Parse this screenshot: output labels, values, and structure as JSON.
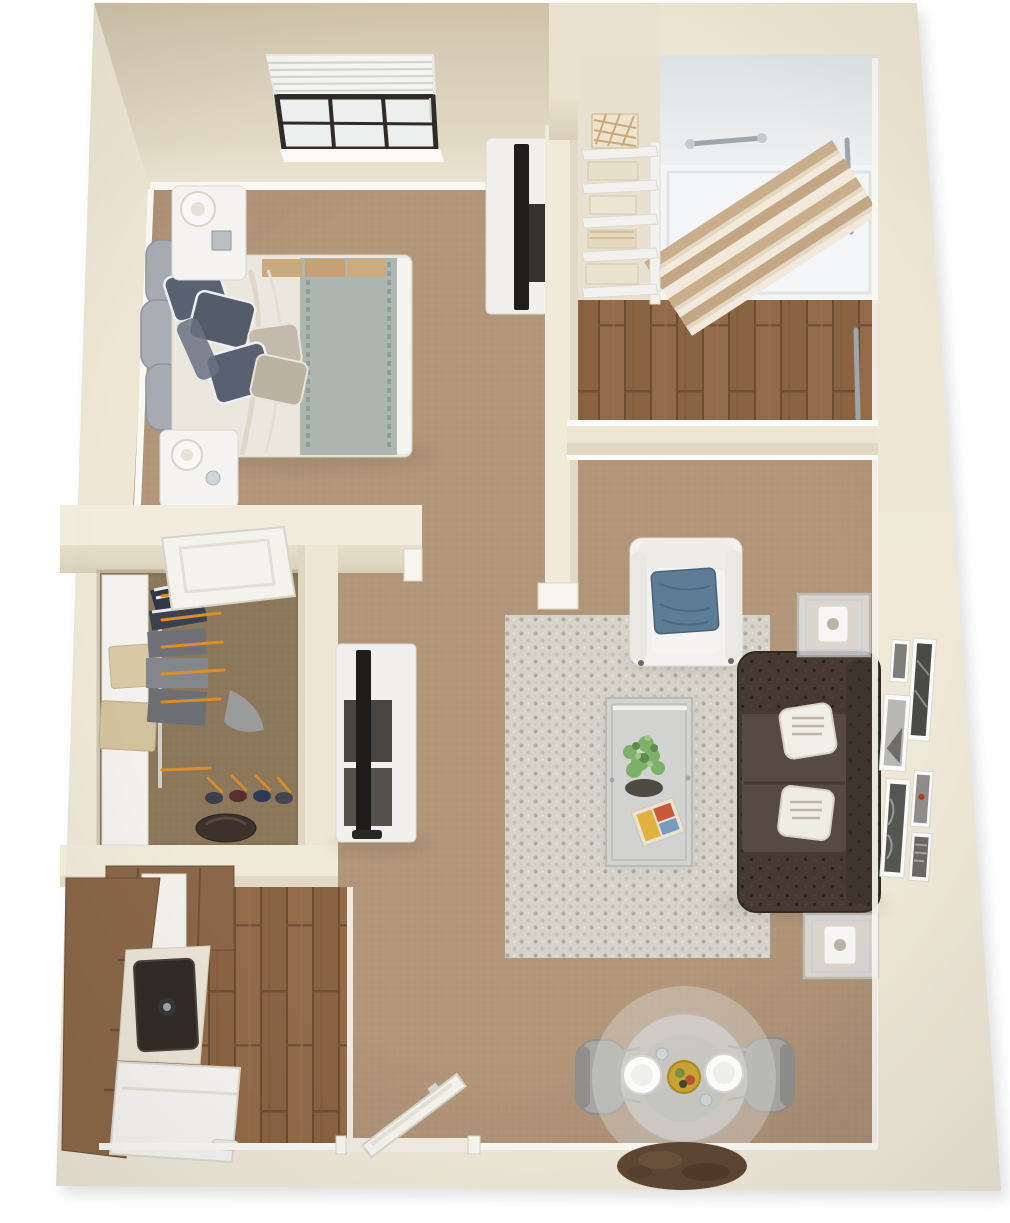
{
  "document": {
    "type": "3d-floor-plan",
    "title": "One-bedroom apartment 3D dollhouse floor plan",
    "view": "top-down perspective, no visible text labels"
  },
  "palette": {
    "wall": "#ECE5D3",
    "wall_shadow": "#D8CDB5",
    "baseboard": "#FAF8F2",
    "carpet_tan": "#B2967A",
    "carpet_closet": "#8D775B",
    "wood_floor": "#8A6343",
    "rug": "#D7D3CB",
    "sofa_brown": "#473A33",
    "pillow_blue": "#5C7D95",
    "armchair_white": "#F2F1ED",
    "bed_duvet": "#EBE7DF",
    "bed_throw": "#AEB6B0",
    "headboard_gray": "#A6AAB1",
    "tv_black": "#1F1D1C",
    "cabinet_brown": "#8A6749",
    "sink_dark": "#332B26",
    "chrome": "#9FA6AB",
    "curtain_tan": "#C9AE8C",
    "mat_brown": "#5E4733",
    "hanger_orange": "#D98E2B",
    "plant_green": "#7FB069",
    "bowl_yellow": "#C9A431"
  },
  "rooms": {
    "bedroom": {
      "label": "Bedroom",
      "floor": "tan carpet",
      "items": [
        "double bed with gray scalloped headboard",
        "gray and white throw pillows",
        "gray folded throw at foot",
        "two white nightstands with lamps",
        "white media console with flat-screen TV",
        "window with half-open venetian blinds"
      ]
    },
    "bathroom": {
      "label": "Bathroom",
      "floor": "hardwood planks",
      "items": [
        "walk-in shower with chrome grab bars",
        "striped shower curtain pulled aside",
        "white linen shelving with towels and patterned basket",
        "chrome towel bar",
        "floor drain"
      ]
    },
    "closet": {
      "label": "Walk-in closet",
      "floor": "brown carpet",
      "items": [
        "white side shelf with two beige storage boxes",
        "hanging clothes on orange hangers",
        "row of shoes",
        "dark duffel bag",
        "open white door"
      ]
    },
    "kitchen": {
      "label": "Kitchen",
      "floor": "hardwood planks",
      "items": [
        "brown cabinet run",
        "upper cabinets with white box",
        "white counter with dark single-basin sink and faucet",
        "white refrigerator"
      ]
    },
    "living_room": {
      "label": "Living room",
      "floor": "tan carpet",
      "items": [
        "dark brown tufted chesterfield sofa",
        "two white accent pillows",
        "white armchair with blue pillow",
        "dotted area rug",
        "glass coffee table with plant and magazine",
        "two glass side tables with white lanterns",
        "white TV console with flat-screen TV",
        "six framed black-and-white prints on wall"
      ]
    },
    "dining_area": {
      "label": "Dining area",
      "items": [
        "round glass table",
        "two gray upholstered chairs",
        "two white plates with cutlery",
        "yellow fruit bowl centerpiece",
        "two glasses"
      ]
    },
    "entry": {
      "label": "Entry",
      "items": [
        "white front door ajar",
        "door threshold",
        "dark brown doormat"
      ]
    }
  }
}
